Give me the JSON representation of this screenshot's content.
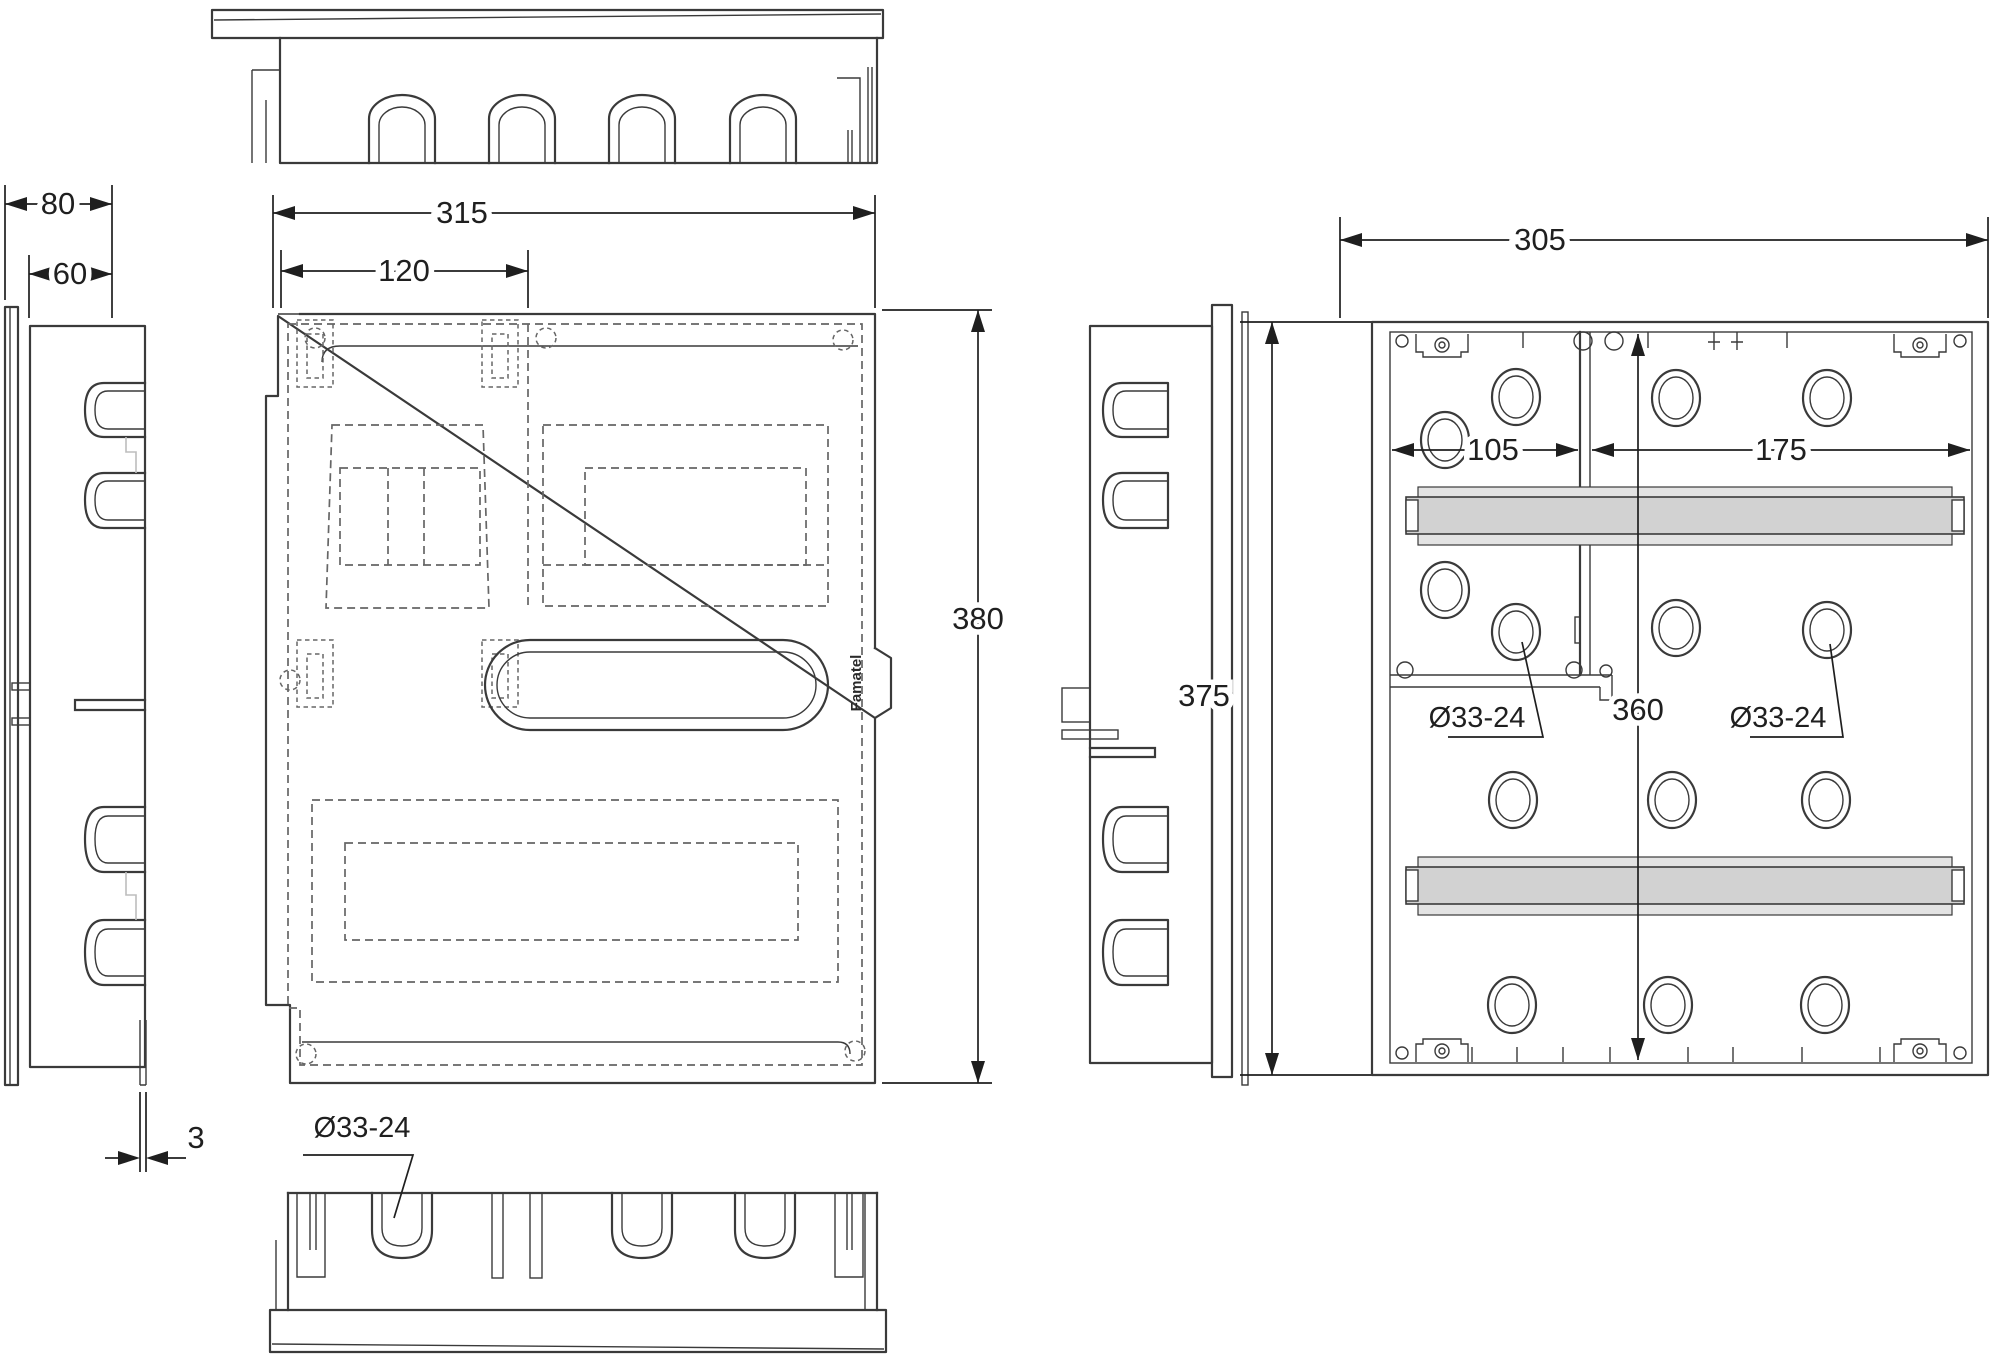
{
  "drawing": {
    "title": "enclosure-technical-drawing",
    "brand": "Famatel",
    "dimensions": {
      "side_depth_total": "80",
      "side_depth_body": "60",
      "top_width": "315",
      "meter_zone_width": "120",
      "front_height": "380",
      "lid_thickness": "3",
      "back_width": "305",
      "back_left_zone": "105",
      "back_right_zone": "175",
      "back_inner_height": "360",
      "back_height": "375",
      "knockout_bottom": "Ø33-24",
      "knockout_back_left": "Ø33-24",
      "knockout_back_right": "Ø33-24"
    },
    "colors": {
      "line": "#3a3a3a",
      "dashed": "#666666",
      "dim": "#1f1f1f",
      "rail_fill": "#d2d2d2",
      "rail_light": "#e3e3e3",
      "background": "#ffffff"
    }
  }
}
